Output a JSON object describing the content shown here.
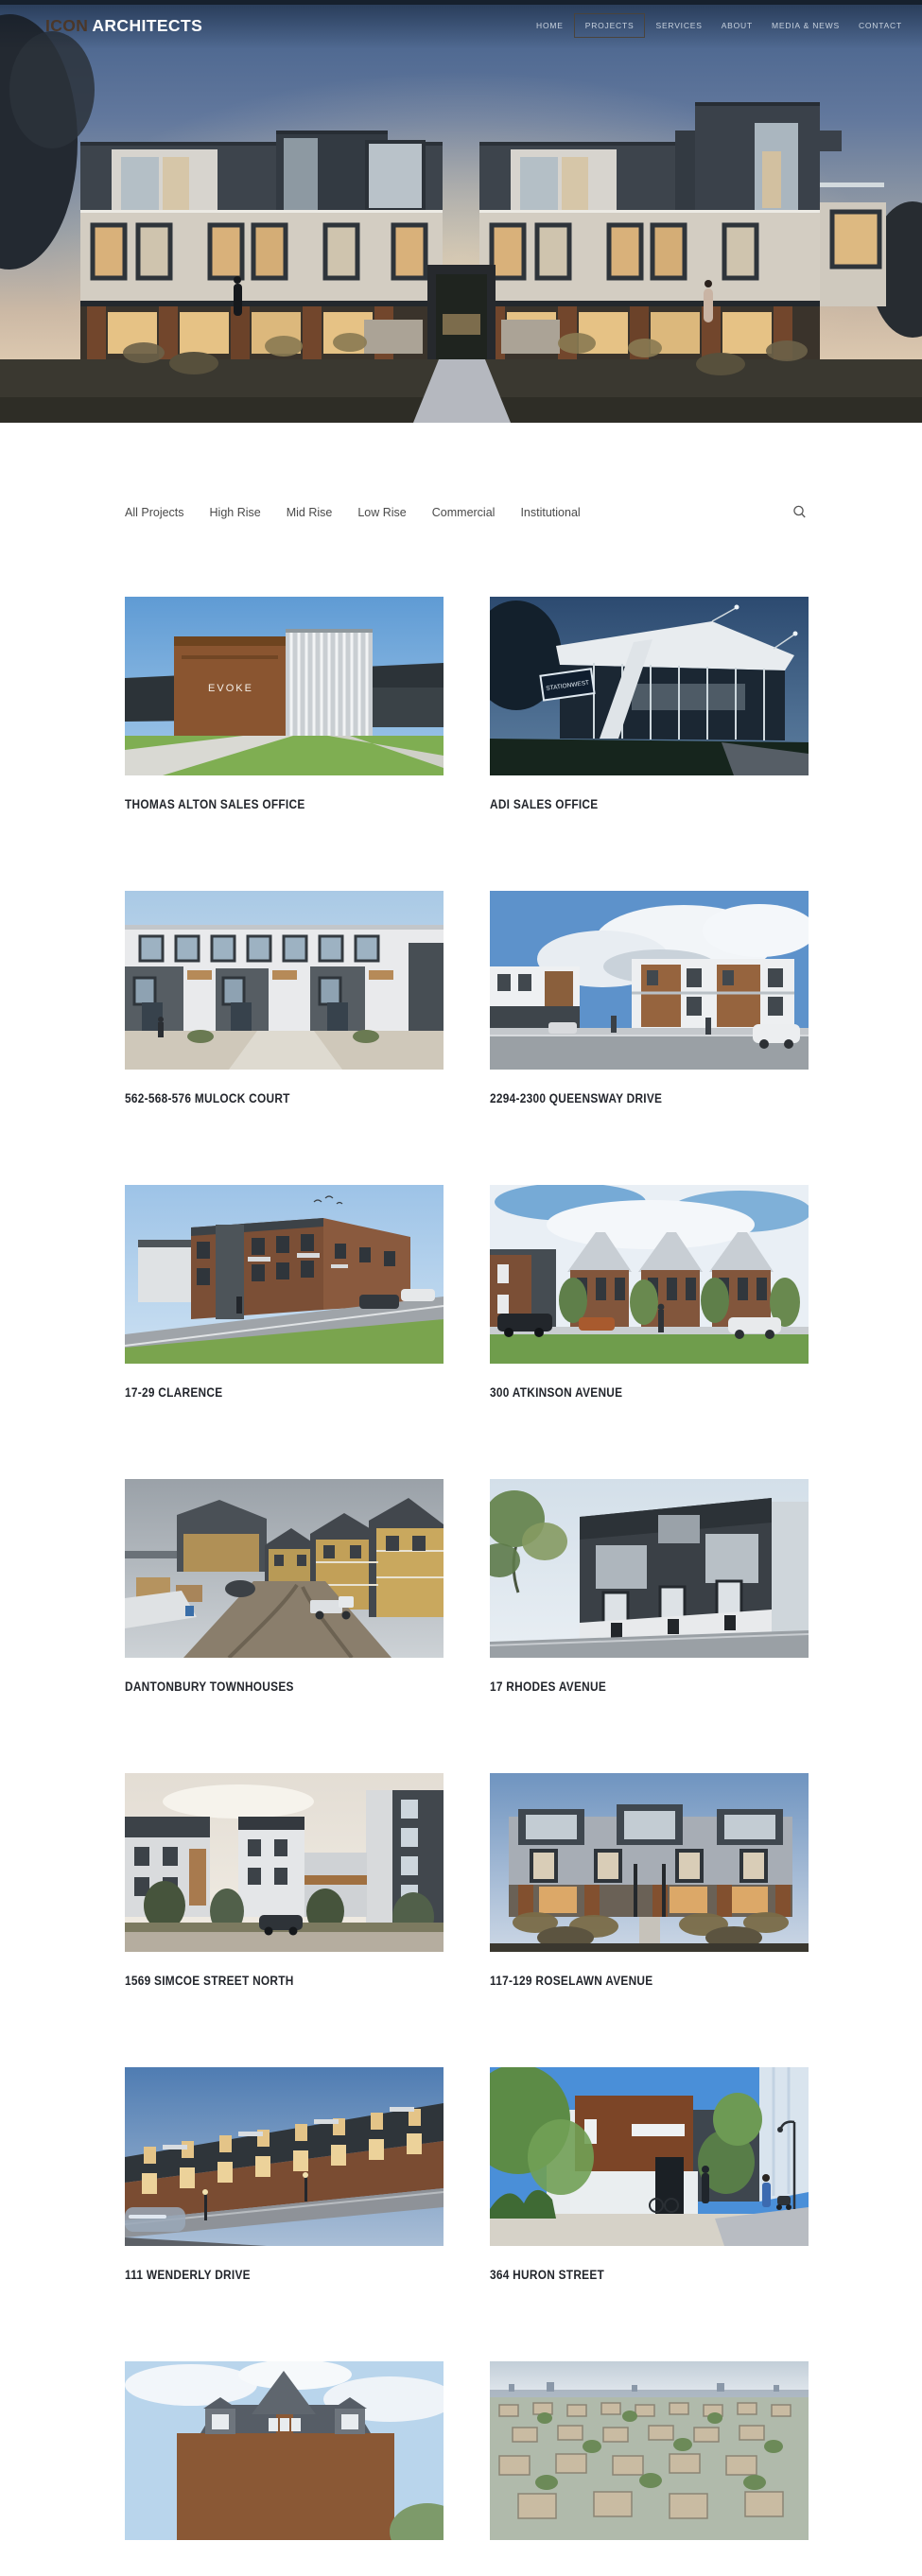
{
  "header": {
    "logo_primary": "ICON",
    "logo_secondary": "ARCHITECTS",
    "nav": [
      {
        "label": "HOME",
        "active": false
      },
      {
        "label": "PROJECTS",
        "active": true
      },
      {
        "label": "SERVICES",
        "active": false
      },
      {
        "label": "ABOUT",
        "active": false
      },
      {
        "label": "MEDIA & NEWS",
        "active": false
      },
      {
        "label": "CONTACT",
        "active": false
      }
    ]
  },
  "filters": {
    "items": [
      {
        "label": "All Projects"
      },
      {
        "label": "High Rise"
      },
      {
        "label": "Mid Rise"
      },
      {
        "label": "Low Rise"
      },
      {
        "label": "Commercial"
      },
      {
        "label": "Institutional"
      }
    ],
    "search_icon": "magnifier"
  },
  "projects": {
    "items": [
      {
        "title": "THOMAS ALTON SALES OFFICE",
        "sign": "EVOKE"
      },
      {
        "title": "ADI SALES OFFICE",
        "sign": "STATIONWEST"
      },
      {
        "title": "562-568-576 MULOCK COURT"
      },
      {
        "title": "2294-2300 QUEENSWAY DRIVE"
      },
      {
        "title": "17-29 CLARENCE"
      },
      {
        "title": "300 ATKINSON AVENUE"
      },
      {
        "title": "DANTONBURY TOWNHOUSES"
      },
      {
        "title": "17 RHODES AVENUE"
      },
      {
        "title": "1569 SIMCOE STREET NORTH"
      },
      {
        "title": "117-129 ROSELAWN AVENUE"
      },
      {
        "title": "111 WENDERLY DRIVE"
      },
      {
        "title": "364 HURON STREET"
      },
      {
        "title": ""
      },
      {
        "title": ""
      }
    ]
  },
  "colors": {
    "logo_brown": "#4B3728",
    "nav_text": "#C9D3DF",
    "nav_active_border": "#4a443c",
    "filter_text": "#4a4a4a",
    "card_title_text": "#23262C",
    "page_background": "#ffffff",
    "top_strip": "#16202d"
  }
}
